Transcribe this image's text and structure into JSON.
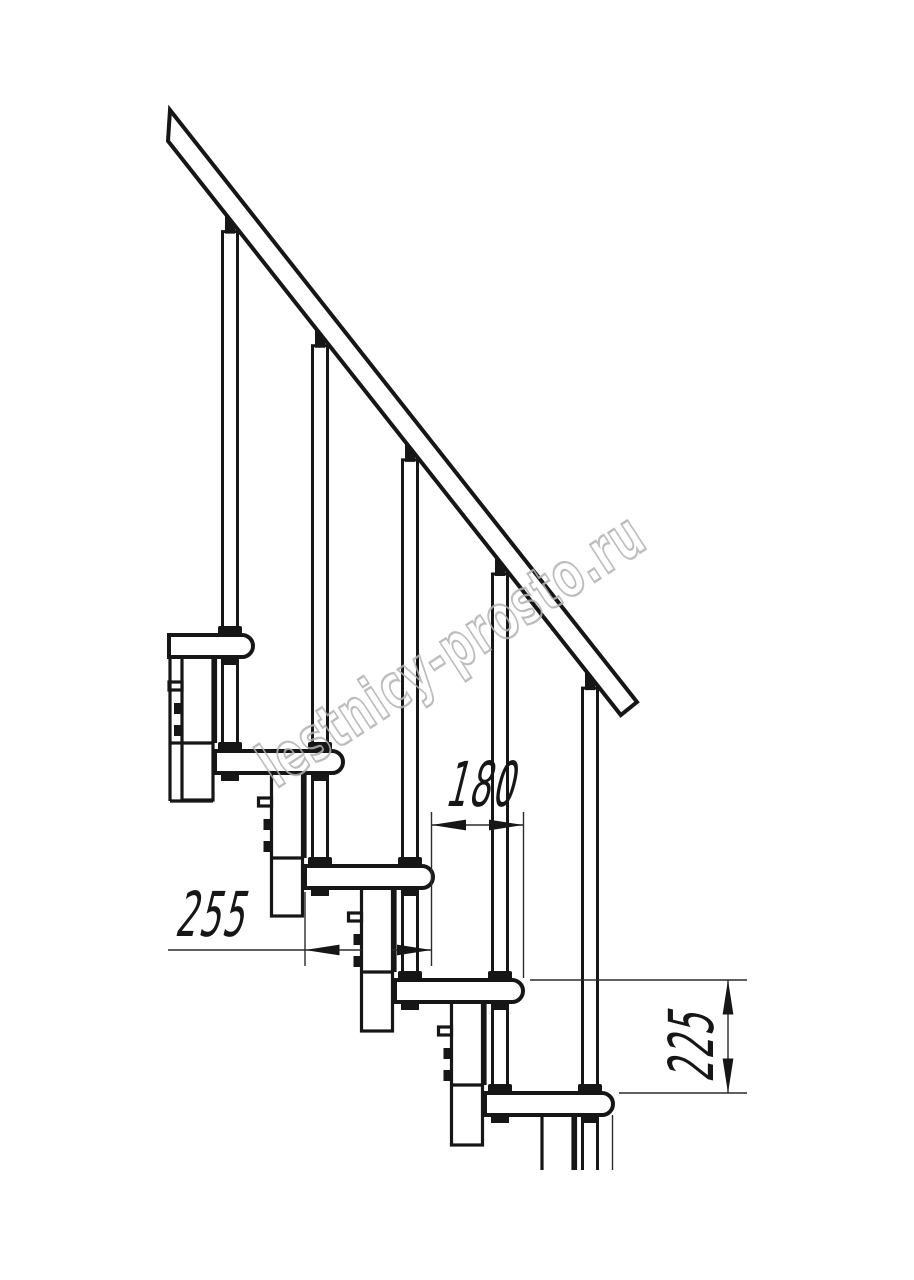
{
  "watermark": {
    "text": "lestnicy-prosto.ru"
  },
  "dimensions": {
    "tread_overlap": {
      "label": "180",
      "orientation": "horizontal"
    },
    "tread_depth": {
      "label": "255",
      "orientation": "horizontal"
    },
    "step_rise": {
      "label": "225",
      "orientation": "vertical"
    }
  },
  "stair": {
    "visible_treads": 5,
    "visible_balusters": 5,
    "visible_support_modules": 5
  },
  "colors": {
    "line": "#161616",
    "watermark_outline": "#b2b2b2",
    "background": "#ffffff"
  }
}
